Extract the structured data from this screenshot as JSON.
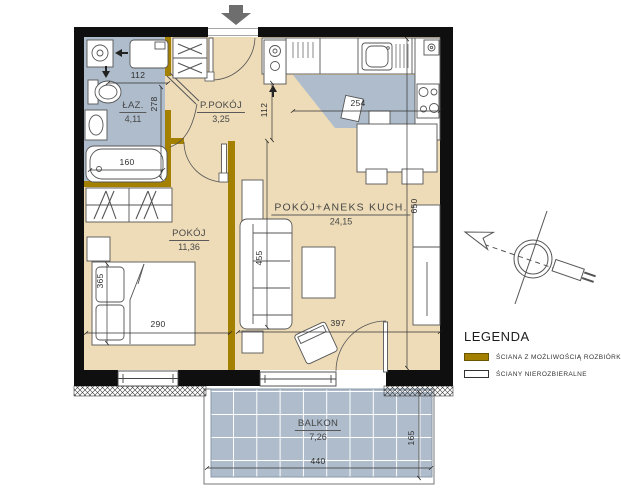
{
  "colors": {
    "wall": "#0f0f0f",
    "demolishable_wall": "#a38000",
    "floor": "#eedcb8",
    "wet_zone": "#aebccb",
    "entrance_arrow": "#6e6e6e"
  },
  "rooms": {
    "bathroom": {
      "name": "ŁAZ.",
      "area": "4,11"
    },
    "hall": {
      "name": "P.POKÓJ",
      "area": "3,25"
    },
    "living": {
      "name": "POKÓJ+ANEKS KUCH.",
      "area": "24,15"
    },
    "bedroom": {
      "name": "POKÓJ",
      "area": "11,36"
    },
    "balcony": {
      "name": "BALKON",
      "area": "7,26"
    }
  },
  "dims": {
    "bath_width": "112",
    "bath_depth": "278",
    "tub_length": "160",
    "hall_passage": "112",
    "kitchen_width": "254",
    "living_depth": "650",
    "sofa_wall": "455",
    "bed_length": "365",
    "bedroom_width": "290",
    "living_width": "397",
    "balcony_width": "440",
    "balcony_depth": "165"
  },
  "legend": {
    "title": "LEGENDA",
    "items": [
      {
        "label": "ŚCIANA Z MOŻLIWOŚCIĄ ROZBIÓRKI"
      },
      {
        "label": "ŚCIANY NIEROZBIERALNE"
      }
    ]
  }
}
